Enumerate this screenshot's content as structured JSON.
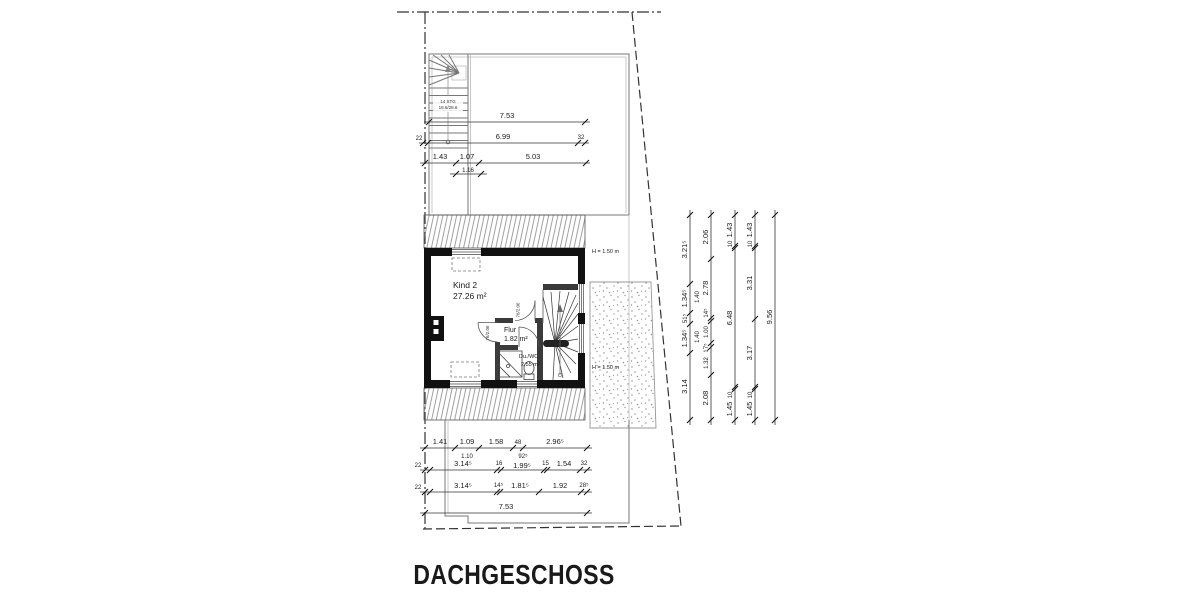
{
  "title": "DACHGESCHOSS",
  "plan": {
    "rooms": {
      "kind2": {
        "name": "Kind 2",
        "area": "27.26 m²"
      },
      "flur": {
        "name": "Flur",
        "area": "1.82 m²"
      },
      "duwc": {
        "name": "Du./WC",
        "area": "2.55 m²"
      }
    },
    "stair": {
      "steps": "14 STG",
      "riser": "18.6/28.6"
    },
    "heights": {
      "upper": "H = 1.50 m",
      "lower": "H = 1.50 m"
    },
    "doors": {
      "flur": "76/2.06",
      "kind2": "76/2.06"
    }
  },
  "dims": {
    "top": {
      "r1": [
        "7.53"
      ],
      "r2": [
        "22",
        "6.99",
        "32"
      ],
      "r3": [
        "1.43",
        "1.07",
        "5.03"
      ],
      "r3b": [
        "1.16"
      ]
    },
    "bottom": {
      "r1": [
        "1.41",
        "1.09",
        "1.58",
        "48",
        "2.96⁵"
      ],
      "r1b": [
        "1.10",
        "92⁵"
      ],
      "r2": [
        "22",
        "3.14⁵",
        "16",
        "1.99⁵",
        "15",
        "1.54",
        "32"
      ],
      "r3": [
        "22",
        "3.14⁵",
        "14⁵",
        "1.81⁵",
        "1.92",
        "28⁵"
      ],
      "r4": [
        "7.53"
      ]
    },
    "right": {
      "c1": [
        "3.21⁵",
        "1.34⁵",
        "51⁵",
        "1.34⁵",
        "3.14"
      ],
      "c1b": [
        "1.40",
        "1.40"
      ],
      "c2": [
        "2.06",
        "2.78",
        "14⁵",
        "1.00",
        "17⁵",
        "1.32",
        "2.08"
      ],
      "c3": [
        "1.43",
        "10",
        "6.48",
        "10",
        "1.45"
      ],
      "c4": [
        "1.43",
        "10",
        "3.31",
        "3.17",
        "10",
        "1.45"
      ],
      "c5": [
        "9.56"
      ]
    }
  }
}
